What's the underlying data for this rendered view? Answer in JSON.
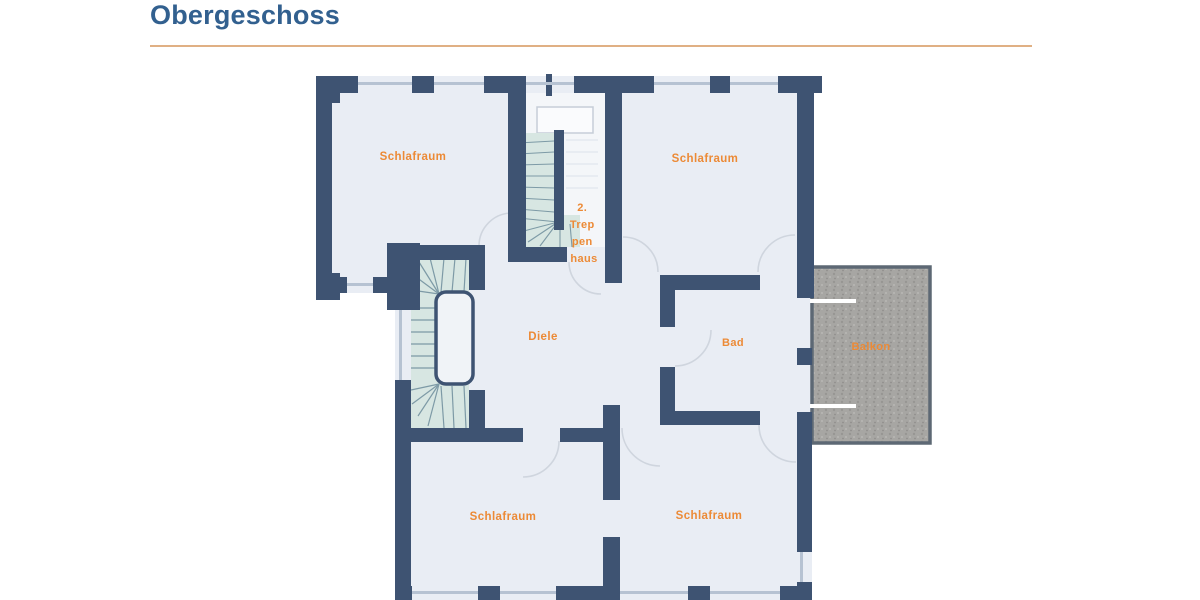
{
  "page": {
    "title": "Obergeschoss"
  },
  "plan": {
    "labels": {
      "bedroom_top_left": "Schlafraum",
      "bedroom_top_right": "Schlafraum",
      "bedroom_bottom_left": "Schlafraum",
      "bedroom_bottom_right": "Schlafraum",
      "hallway": "Diele",
      "bathroom": "Bad",
      "balcony": "Balkon",
      "stairwell_lines": [
        "2.",
        "Trep",
        "pen",
        "haus"
      ]
    }
  },
  "colors": {
    "title-blue": "#32608f",
    "rule-orange": "#e0b084",
    "label-orange": "#ec8a36",
    "wall": "#3e5372",
    "room-fill": "#e9edf4",
    "stairwell-fill": "#f4f6f9",
    "window-line": "#b6c2d2",
    "door-arc": "#cfd5de",
    "stair-teal": "#d7e6e2",
    "stair-tread": "#7d9aa6",
    "balcony-fill": "#a7a6a3",
    "balcony-border": "#5d6874"
  }
}
